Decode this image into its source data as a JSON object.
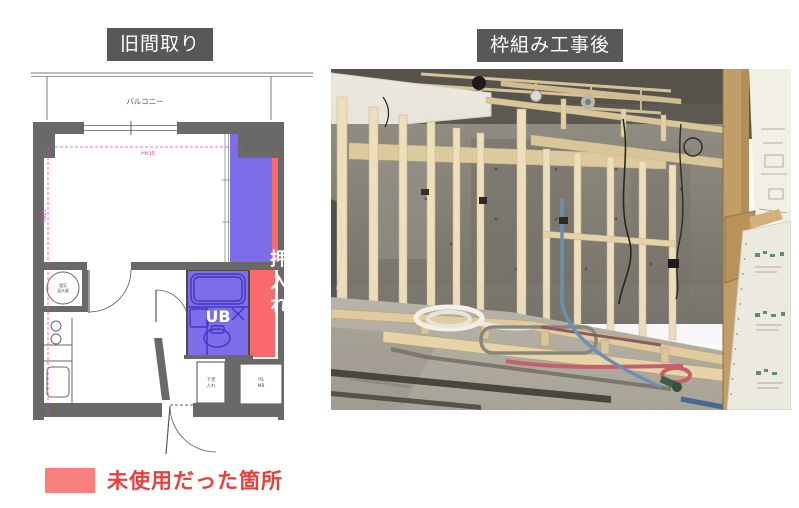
{
  "titles": {
    "left": "旧間取り",
    "right": "枠組み工事後"
  },
  "title_style": {
    "background": "#595757",
    "text": "#ffffff"
  },
  "floorplan": {
    "balcony": "バルコニー",
    "closet": "押入れ",
    "unit_bath": "UB",
    "water_heater_line1": "電気",
    "water_heater_line2": "温水器",
    "shoe_cabinet_line1": "下足",
    "shoe_cabinet_line2": "入れ",
    "pipe_space_line1": "PS",
    "pipe_space_line2": "MB",
    "dim_horizontal": "HH15",
    "dim_vertical": "H915",
    "colors": {
      "wall": "#6b6968",
      "reused_overlay_blue": "#7b6ee8",
      "unused_overlay_red": "#f9696e",
      "dimension_magenta": "#ee3cd4"
    }
  },
  "legend": {
    "label": "未使用だった箇所",
    "swatch_color": "#f97f7f",
    "text_color": "#e8403c"
  }
}
